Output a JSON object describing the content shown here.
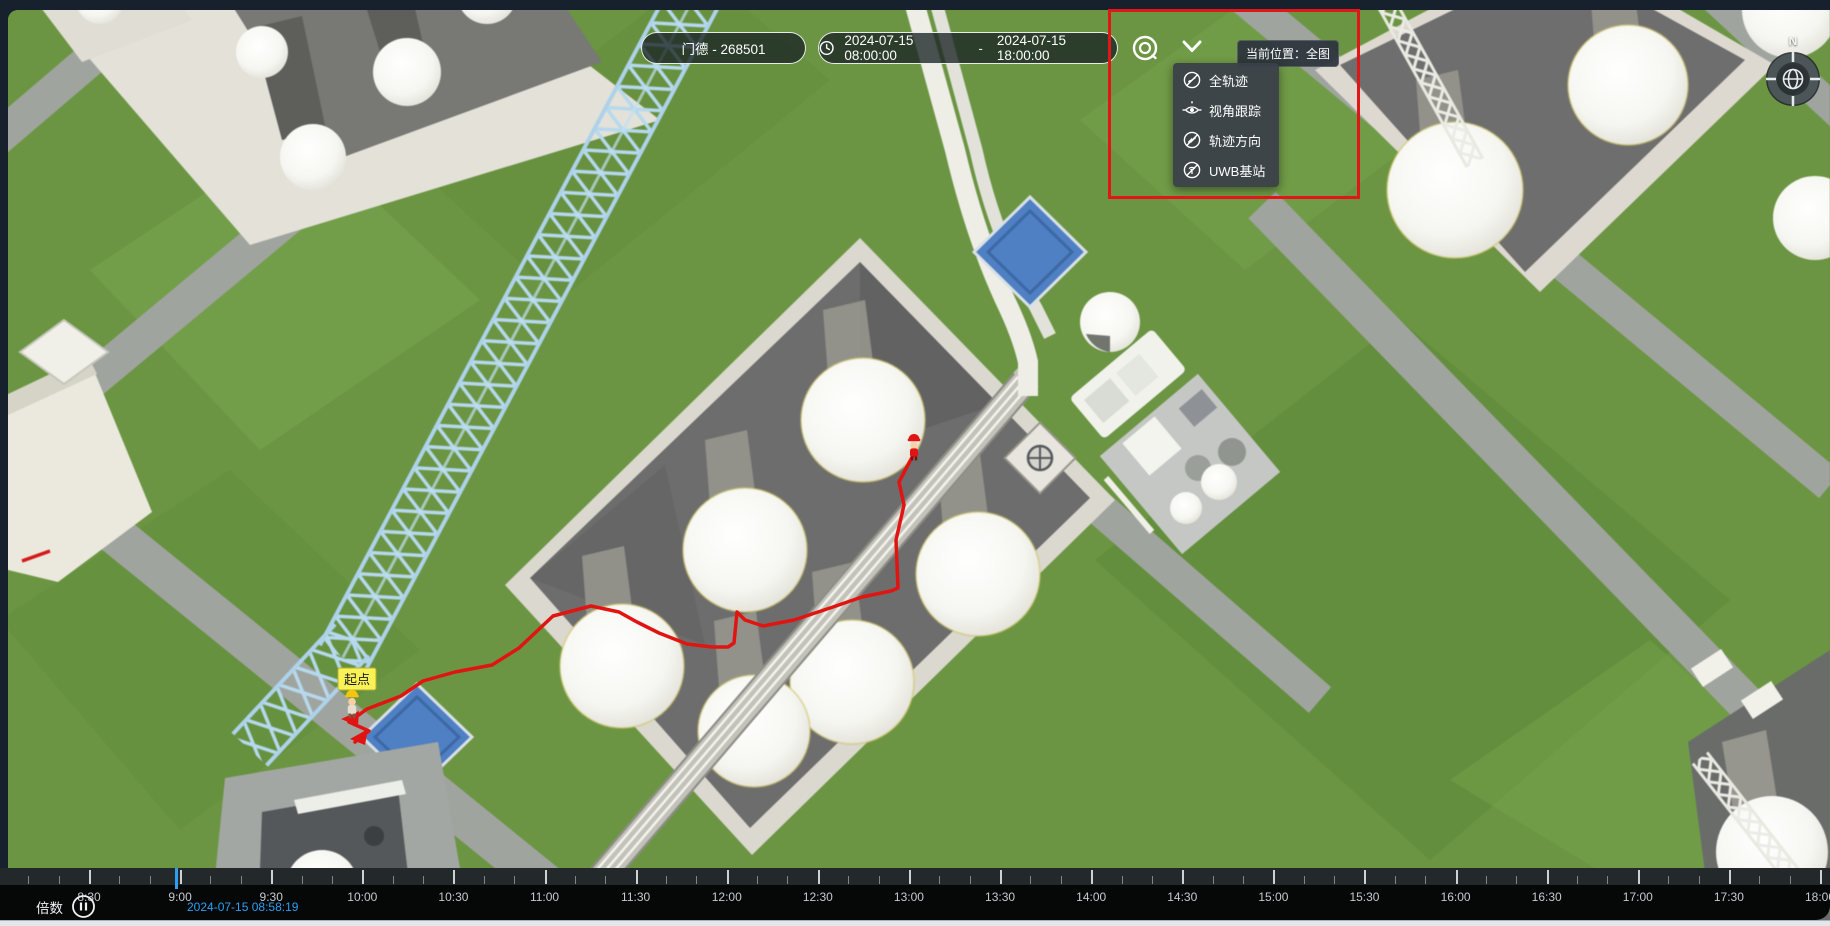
{
  "toolbar": {
    "target": {
      "label": "门德 - 268501"
    },
    "time_range": {
      "start": "2024-07-15 08:00:00",
      "separator": "-",
      "end": "2024-07-15 18:00:00"
    },
    "location_tag": "当前位置：全图"
  },
  "layers_menu": {
    "items": [
      {
        "label": "全轨迹",
        "icon": "trajectory-icon"
      },
      {
        "label": "视角跟踪",
        "icon": "view-follow-icon"
      },
      {
        "label": "轨迹方向",
        "icon": "trajectory-direction-icon"
      },
      {
        "label": "UWB基站",
        "icon": "uwb-station-icon"
      }
    ]
  },
  "compass": {
    "north_label": "N"
  },
  "map": {
    "start_point_label": "起点"
  },
  "timeline": {
    "speed_label": "倍数",
    "current_time": "2024-07-15 08:58:19",
    "labels": [
      "8:30",
      "9:00",
      "9:30",
      "10:00",
      "10:30",
      "11:00",
      "11:30",
      "12:00",
      "12:30",
      "13:00",
      "13:30",
      "14:00",
      "14:30",
      "15:00",
      "15:30",
      "16:00",
      "16:30",
      "17:00",
      "17:30",
      "18:00"
    ]
  },
  "colors": {
    "trajectory_red": "#e01511",
    "annotation_red": "#e11717",
    "playhead_blue": "#2d9ff2",
    "pool_blue": "#4b80c8",
    "start_label_yellow": "#f9f257"
  }
}
